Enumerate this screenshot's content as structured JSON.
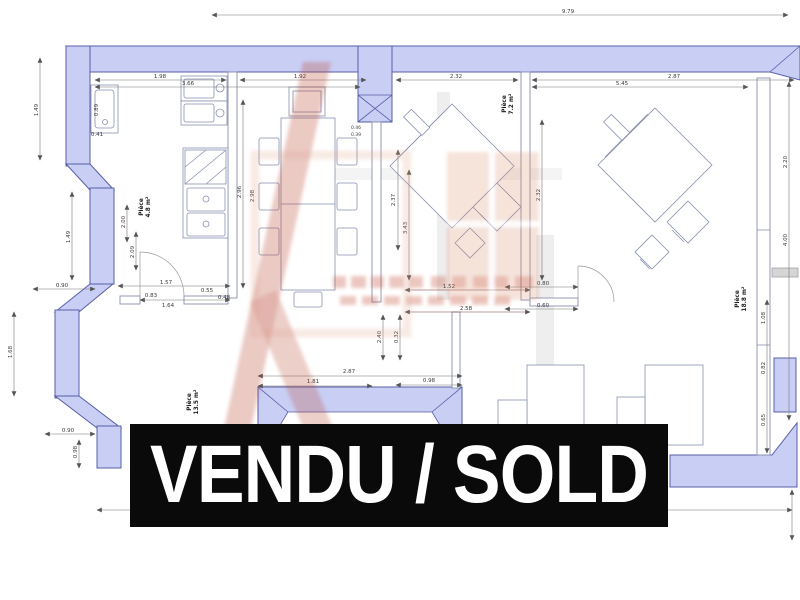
{
  "banner": {
    "label": "VENDU / SOLD",
    "bg": "#0a0a0a",
    "fg": "#ffffff"
  },
  "plan": {
    "wall_fill": "#c9cef5",
    "wall_stroke": "#585da6",
    "rooms": [
      {
        "name": "Pièce",
        "area": "4.8 m²"
      },
      {
        "name": "Pièce",
        "area": "7.2 m²"
      },
      {
        "name": "Pièce",
        "area": "18.8 m²"
      },
      {
        "name": "Pièce",
        "area": "13.5 m²"
      }
    ],
    "overall_width": "9.79",
    "dims": [
      "9.79",
      "1.98",
      "3.66",
      "1.92",
      "2.32",
      "5.45",
      "2.87",
      "1.49",
      "0.89",
      "0.41",
      "1.49",
      "0.90",
      "1.68",
      "0.90",
      "0.98",
      "2.00",
      "2.09",
      "2.96",
      "2.98",
      "1.57",
      "0.83",
      "1.64",
      "0.55",
      "0.48",
      "0.46",
      "0.39",
      "2.37",
      "3.43",
      "2.32",
      "2.40",
      "0.32",
      "1.52",
      "2.58",
      "0.80",
      "0.60",
      "2.87",
      "1.81",
      "0.98",
      "2.20",
      "4.00",
      "1.08",
      "0.82",
      "0.65"
    ],
    "watermark_colors": {
      "red": "#b6402c",
      "salmon": "#d9906d"
    }
  }
}
